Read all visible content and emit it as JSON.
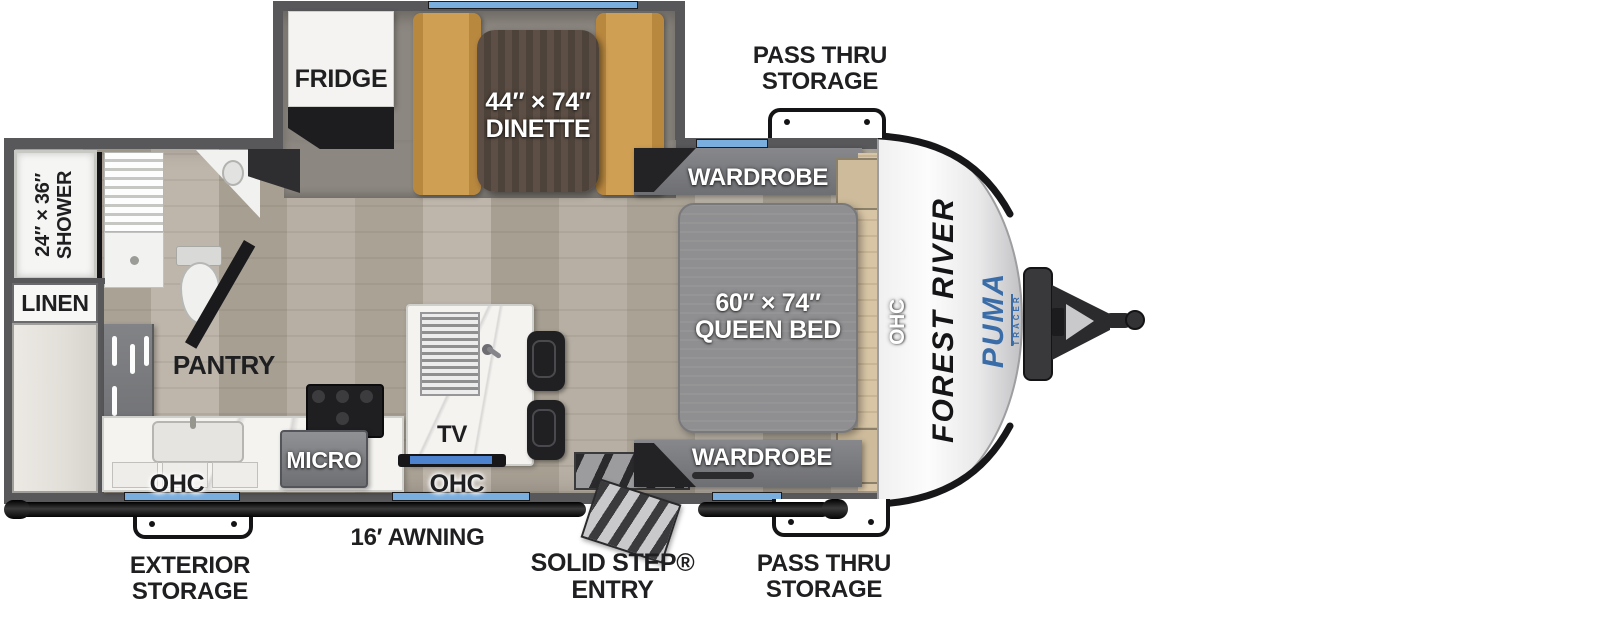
{
  "title": "Travel trailer floor plan",
  "brand": {
    "manufacturer": "FOREST RIVER",
    "model": "PUMA",
    "model_sub": "TRACER"
  },
  "labels": {
    "pass_thru_top": {
      "line1": "PASS THRU",
      "line2": "STORAGE"
    },
    "pass_thru_bottom": {
      "line1": "PASS THRU",
      "line2": "STORAGE"
    },
    "exterior_storage": {
      "line1": "EXTERIOR",
      "line2": "STORAGE"
    },
    "awning": "16′ AWNING",
    "entry": "SOLID STEP® ENTRY",
    "fridge": "FRIDGE",
    "dinette": {
      "line1": "44″ × 74″",
      "line2": "DINETTE"
    },
    "wardrobe_top": "WARDROBE",
    "wardrobe_bottom": "WARDROBE",
    "queen_bed": {
      "line1": "60″ × 74″",
      "line2": "QUEEN BED"
    },
    "shower": {
      "line1": "24″ × 36″",
      "line2": "SHOWER"
    },
    "linen": "LINEN",
    "pantry": "PANTRY",
    "micro": "MICRO",
    "tv": "TV",
    "ohc_kitchen_left": "OHC",
    "ohc_kitchen_mid": "OHC",
    "ohc_front": "OHC"
  },
  "colors": {
    "wall": "#58585a",
    "floor": "#b4ac9f",
    "carpet": "#8c8780",
    "dinette_bench": "#c8984c",
    "dinette_table": "#564a41",
    "bed": "#8f8f91",
    "window_accent": "#7aaede",
    "tv_screen": "#4d82cf",
    "puma_blue": "#3a6da8",
    "label_dark": "#1f1f21"
  }
}
